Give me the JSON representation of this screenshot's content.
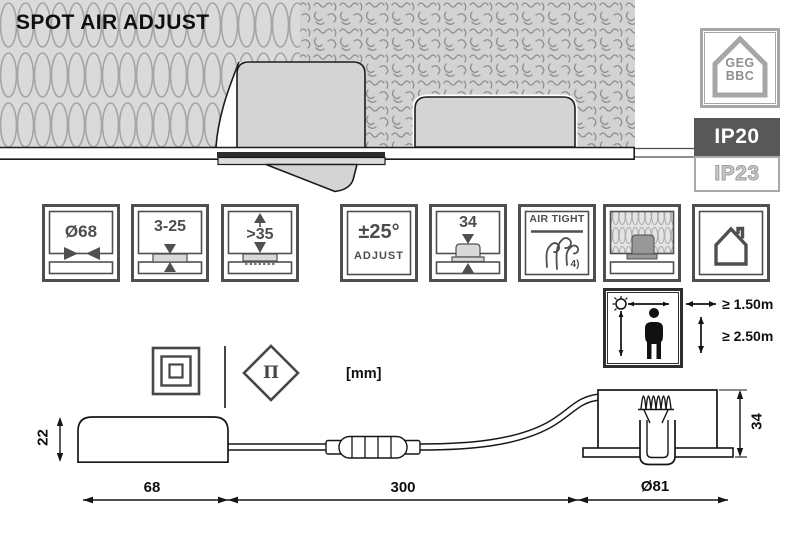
{
  "title": "SPOT AIR ADJUST",
  "units_label": "[mm]",
  "right_column": {
    "house_badge": {
      "line1": "GEG",
      "line2": "BBC"
    },
    "ip_top": "IP20",
    "ip_bottom": "IP23"
  },
  "feature_icons": [
    {
      "id": "cutout-diameter",
      "label": "Ø68"
    },
    {
      "id": "ceiling-thickness",
      "label": "3-25"
    },
    {
      "id": "min-recess-depth",
      "label": ">35"
    },
    {
      "id": "tilt-adjust",
      "label": "±25°",
      "sublabel": "ADJUST"
    },
    {
      "id": "fixture-height",
      "label": "34"
    },
    {
      "id": "airtight",
      "label": "AIR TIGHT",
      "footnote": "4)"
    },
    {
      "id": "insulation-coverable"
    },
    {
      "id": "indoor-use"
    }
  ],
  "clearance": {
    "horizontal": "≥ 1.50m",
    "vertical": "≥ 2.50m"
  },
  "symbols": {
    "protection_class": "class-ii",
    "diamond_glyph": "Π"
  },
  "dimensions": {
    "driver_height": "22",
    "driver_length": "68",
    "cable_length": "300",
    "head_diameter": "Ø81",
    "head_height": "34"
  },
  "colors": {
    "badge_dark": "#58585a",
    "icon_stroke": "#4f4f52",
    "line": "#161616",
    "muted_gray": "#a6a6a6"
  }
}
